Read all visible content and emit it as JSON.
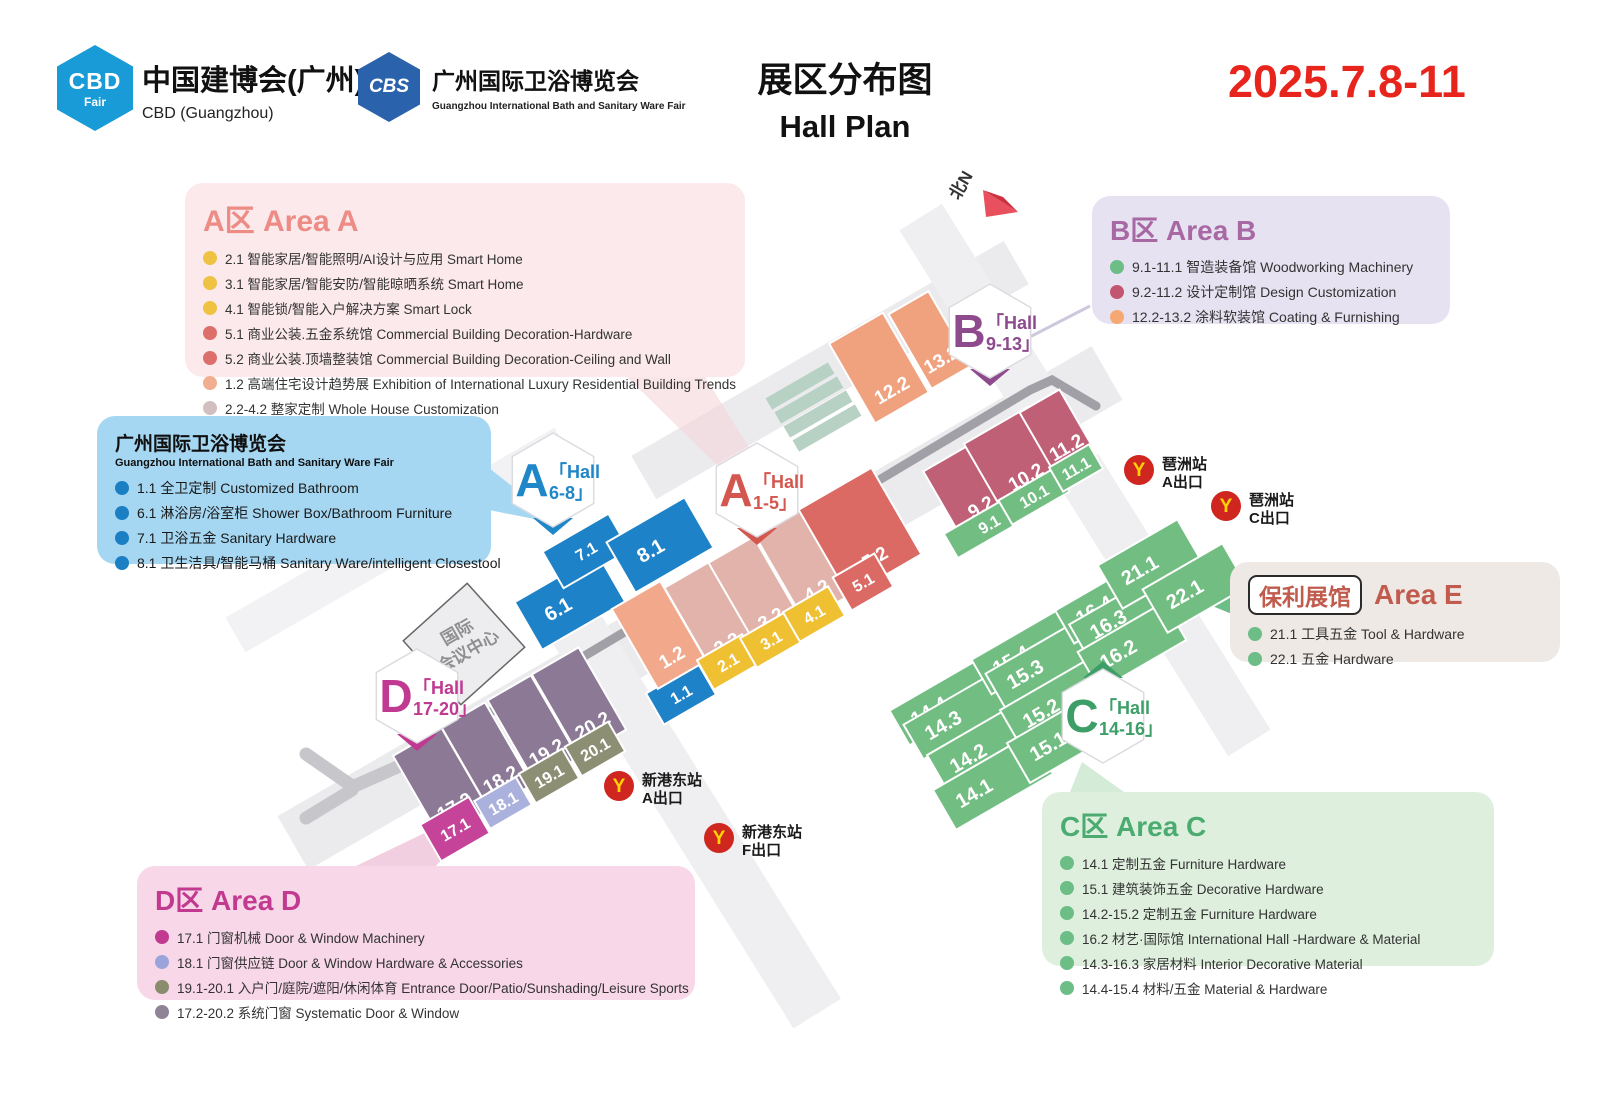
{
  "header": {
    "logo_cbd": {
      "badge_line1": "CBD",
      "badge_line2": "Fair",
      "title": "中国建博会(广州)",
      "subtitle": "CBD (Guangzhou)"
    },
    "logo_cbs": {
      "badge": "CBS",
      "title": "广州国际卫浴博览会",
      "subtitle": "Guangzhou International Bath and Sanitary Ware Fair"
    },
    "title_cn": "展区分布图",
    "title_en": "Hall Plan",
    "date": "2025.7.8-11"
  },
  "legends": {
    "a": {
      "title": "A区 Area A",
      "items": [
        {
          "dot": "#efc243",
          "text": "2.1 智能家居/智能照明/AI设计与应用 Smart Home"
        },
        {
          "dot": "#efc243",
          "text": "3.1 智能家居/智能安防/智能晾晒系统 Smart Home"
        },
        {
          "dot": "#efc243",
          "text": "4.1 智能锁/智能入户解决方案 Smart Lock"
        },
        {
          "dot": "#dd6f6b",
          "text": "5.1 商业公装.五金系统馆 Commercial Building Decoration-Hardware"
        },
        {
          "dot": "#dd6f6b",
          "text": "5.2 商业公装.顶墙整装馆 Commercial Building Decoration-Ceiling and Wall"
        },
        {
          "dot": "#f2ae90",
          "text": "1.2 高端住宅设计趋势展 Exhibition of International Luxury Residential Building Trends"
        },
        {
          "dot": "#d2bfc0",
          "text": "2.2-4.2 整家定制 Whole House Customization"
        }
      ]
    },
    "bath": {
      "title": "广州国际卫浴博览会",
      "subtitle": "Guangzhou International Bath and Sanitary Ware Fair",
      "items": [
        {
          "dot": "#1b7fc4",
          "text": "1.1 全卫定制 Customized Bathroom"
        },
        {
          "dot": "#1b7fc4",
          "text": "6.1 淋浴房/浴室柜 Shower Box/Bathroom Furniture"
        },
        {
          "dot": "#1b7fc4",
          "text": "7.1 卫浴五金 Sanitary Hardware"
        },
        {
          "dot": "#1b7fc4",
          "text": "8.1 卫生洁具/智能马桶 Sanitary Ware/intelligent Closestool"
        }
      ]
    },
    "b": {
      "title": "B区 Area B",
      "items": [
        {
          "dot": "#6cbd86",
          "text": "9.1-11.1 智造装备馆 Woodworking Machinery"
        },
        {
          "dot": "#c25670",
          "text": "9.2-11.2 设计定制馆 Design Customization"
        },
        {
          "dot": "#f6a873",
          "text": "12.2-13.2 涂料软装馆 Coating & Furnishing"
        }
      ]
    },
    "e": {
      "hall_badge": "保利展馆",
      "title": "Area E",
      "items": [
        {
          "dot": "#6cbd86",
          "text": "21.1 工具五金 Tool & Hardware"
        },
        {
          "dot": "#6cbd86",
          "text": "22.1 五金 Hardware"
        }
      ]
    },
    "c": {
      "title": "C区 Area C",
      "items": [
        {
          "dot": "#6cbd86",
          "text": "14.1 定制五金 Furniture Hardware"
        },
        {
          "dot": "#6cbd86",
          "text": "15.1 建筑装饰五金 Decorative Hardware"
        },
        {
          "dot": "#6cbd86",
          "text": "14.2-15.2 定制五金 Furniture Hardware"
        },
        {
          "dot": "#6cbd86",
          "text": "16.2 材艺·国际馆 International Hall -Hardware & Material"
        },
        {
          "dot": "#6cbd86",
          "text": "14.3-16.3 家居材料 Interior Decorative Material"
        },
        {
          "dot": "#6cbd86",
          "text": "14.4-15.4 材料/五金 Material & Hardware"
        }
      ]
    },
    "d": {
      "title": "D区 Area D",
      "items": [
        {
          "dot": "#c13a90",
          "text": "17.1 门窗机械  Door & Window Machinery"
        },
        {
          "dot": "#9ba4da",
          "text": "18.1 门窗供应链  Door & Window Hardware & Accessories"
        },
        {
          "dot": "#8a8c6e",
          "text": "19.1-20.1 入户门/庭院/遮阳/休闲体育 Entrance Door/Patio/Sunshading/Leisure Sports"
        },
        {
          "dot": "#8f8398",
          "text": "17.2-20.2 系统门窗 Systematic Door & Window"
        }
      ]
    }
  },
  "colors": {
    "halls": {
      "blue": "#1e82c8",
      "yellow": "#f0c033",
      "dustypink": "#e2b3ab",
      "salmon": "#f2a98b",
      "red": "#dc6a64",
      "orange": "#f0a17e",
      "darkpink": "#bf6077",
      "green": "#72bd82",
      "purple": "#8b7995",
      "magenta": "#c5449a",
      "periwinkle": "#abb1dd",
      "olive": "#8d8f75",
      "sage": "#b7d2c4"
    },
    "date_red": "#e8251d",
    "metro_red": "#cf2620",
    "metro_yellow": "#ffd400"
  },
  "map": {
    "north_label": "北N",
    "landmark": {
      "line1": "国际",
      "line2": "会议中心"
    },
    "roads": [
      {
        "x": 700,
        "y": 608,
        "w": 940,
        "h": 62,
        "rot": -30,
        "fill": "#ebebee"
      },
      {
        "x": 830,
        "y": 370,
        "w": 430,
        "h": 50,
        "rot": -30,
        "fill": "#ebebee"
      },
      {
        "x": 1085,
        "y": 480,
        "w": 620,
        "h": 50,
        "rot": 58,
        "fill": "#efeff1"
      },
      {
        "x": 690,
        "y": 810,
        "w": 480,
        "h": 56,
        "rot": 58,
        "fill": "#efeff1"
      },
      {
        "x": 400,
        "y": 540,
        "w": 380,
        "h": 40,
        "rot": -30,
        "fill": "#f2f2f4"
      },
      {
        "d": "M 390,772 L 1030,390 L 1052,380 L 1096,406",
        "stroke": "#a0a0a6",
        "sw": 9,
        "name": "road-main"
      },
      {
        "d": "M 306,754 L 352,786",
        "stroke": "#c6c6cb",
        "sw": 13,
        "name": "road-fork"
      },
      {
        "d": "M 306,818 L 352,790",
        "stroke": "#c6c6cb",
        "sw": 13,
        "name": "road-fork"
      },
      {
        "d": "M 350,788 L 404,764",
        "stroke": "#c6c6cb",
        "sw": 13,
        "name": "road-fork"
      }
    ],
    "beams": [
      {
        "points": "622,372 702,372 768,478 740,488",
        "fill": "#f5d6db",
        "opacity": 0.6,
        "name": "pointer-area-a"
      },
      {
        "points": "489,468 560,524 489,510",
        "fill": "#a5d7f2",
        "opacity": 1,
        "name": "pointer-bath"
      },
      {
        "d": "M 1090,306 L 1016,344",
        "stroke": "#cfc8dd",
        "sw": 3,
        "name": "pointer-area-b"
      },
      {
        "points": "1232,580 1232,614 1190,597",
        "fill": "#6cbd86",
        "opacity": 1,
        "name": "pointer-area-e"
      },
      {
        "points": "1082,762 1124,792 1066,802",
        "fill": "#d4ebd8",
        "opacity": 1,
        "name": "pointer-area-c"
      },
      {
        "points": "497,798 356,866 436,866",
        "fill": "#f0c6dc",
        "opacity": 0.85,
        "name": "pointer-area-d"
      }
    ],
    "halls": [
      {
        "label": "6.1",
        "x": 570,
        "y": 602,
        "w": 96,
        "h": 55,
        "c": "blue"
      },
      {
        "label": "7.1",
        "x": 586,
        "y": 551,
        "w": 76,
        "h": 42,
        "c": "blue"
      },
      {
        "label": "8.1",
        "x": 660,
        "y": 545,
        "w": 90,
        "h": 58,
        "c": "blue"
      },
      {
        "label": "1.1",
        "x": 681,
        "y": 694,
        "w": 60,
        "h": 36,
        "c": "blue"
      },
      {
        "label": "1.2",
        "x": 659,
        "y": 635,
        "w": 56,
        "h": 92,
        "c": "salmon"
      },
      {
        "label": "2.2",
        "x": 712,
        "y": 618,
        "w": 52,
        "h": 100,
        "c": "dustypink"
      },
      {
        "label": "3.2",
        "x": 756,
        "y": 593,
        "w": 52,
        "h": 100,
        "c": "dustypink"
      },
      {
        "label": "4.2",
        "x": 802,
        "y": 565,
        "w": 52,
        "h": 100,
        "c": "dustypink"
      },
      {
        "label": "5.2",
        "x": 860,
        "y": 532,
        "w": 84,
        "h": 100,
        "c": "red"
      },
      {
        "label": "2.1",
        "x": 728,
        "y": 662,
        "w": 52,
        "h": 34,
        "c": "yellow"
      },
      {
        "label": "3.1",
        "x": 771,
        "y": 640,
        "w": 52,
        "h": 34,
        "c": "yellow"
      },
      {
        "label": "4.1",
        "x": 814,
        "y": 614,
        "w": 52,
        "h": 34,
        "c": "yellow"
      },
      {
        "label": "5.1",
        "x": 863,
        "y": 582,
        "w": 48,
        "h": 38,
        "c": "red"
      },
      {
        "label": "12.2",
        "x": 879,
        "y": 368,
        "w": 62,
        "h": 92,
        "c": "orange"
      },
      {
        "label": "13.2",
        "x": 930,
        "y": 340,
        "w": 46,
        "h": 86,
        "c": "orange"
      },
      {
        "label": "9.2",
        "x": 971,
        "y": 490,
        "w": 64,
        "h": 80,
        "c": "darkpink"
      },
      {
        "label": "10.2",
        "x": 1016,
        "y": 460,
        "w": 74,
        "h": 80,
        "c": "darkpink"
      },
      {
        "label": "11.2",
        "x": 1058,
        "y": 433,
        "w": 46,
        "h": 74,
        "c": "darkpink"
      },
      {
        "label": "9.1",
        "x": 989,
        "y": 524,
        "w": 88,
        "h": 28,
        "c": "green"
      },
      {
        "label": "10.1",
        "x": 1034,
        "y": 496,
        "w": 66,
        "h": 28,
        "c": "green"
      },
      {
        "label": "11.1",
        "x": 1076,
        "y": 468,
        "w": 46,
        "h": 28,
        "c": "green"
      },
      {
        "label": "",
        "x": 800,
        "y": 386,
        "w": 72,
        "h": 13,
        "c": "sage"
      },
      {
        "label": "",
        "x": 809,
        "y": 400,
        "w": 72,
        "h": 13,
        "c": "sage"
      },
      {
        "label": "",
        "x": 818,
        "y": 414,
        "w": 72,
        "h": 13,
        "c": "sage"
      },
      {
        "label": "",
        "x": 827,
        "y": 428,
        "w": 72,
        "h": 13,
        "c": "sage"
      },
      {
        "label": "17.2",
        "x": 441,
        "y": 783,
        "w": 56,
        "h": 95,
        "c": "purple"
      },
      {
        "label": "18.2",
        "x": 487,
        "y": 756,
        "w": 50,
        "h": 95,
        "c": "purple"
      },
      {
        "label": "19.2",
        "x": 533,
        "y": 729,
        "w": 50,
        "h": 95,
        "c": "purple"
      },
      {
        "label": "20.2",
        "x": 579,
        "y": 702,
        "w": 54,
        "h": 95,
        "c": "purple"
      },
      {
        "label": "17.1",
        "x": 455,
        "y": 829,
        "w": 56,
        "h": 42,
        "c": "magenta"
      },
      {
        "label": "18.1",
        "x": 503,
        "y": 803,
        "w": 48,
        "h": 32,
        "c": "periwinkle"
      },
      {
        "label": "19.1",
        "x": 549,
        "y": 776,
        "w": 50,
        "h": 34,
        "c": "olive"
      },
      {
        "label": "20.1",
        "x": 595,
        "y": 749,
        "w": 50,
        "h": 34,
        "c": "olive"
      },
      {
        "label": "14.4",
        "x": 948,
        "y": 700,
        "w": 112,
        "h": 40,
        "c": "green"
      },
      {
        "label": "14.3",
        "x": 962,
        "y": 714,
        "w": 112,
        "h": 40,
        "c": "green"
      },
      {
        "label": "14.2",
        "x": 987,
        "y": 747,
        "w": 112,
        "h": 46,
        "c": "green"
      },
      {
        "label": "14.1",
        "x": 993,
        "y": 782,
        "w": 112,
        "h": 46,
        "c": "green"
      },
      {
        "label": "15.4",
        "x": 1030,
        "y": 649,
        "w": 112,
        "h": 40,
        "c": "green"
      },
      {
        "label": "15.3",
        "x": 1044,
        "y": 663,
        "w": 112,
        "h": 40,
        "c": "green"
      },
      {
        "label": "15.2",
        "x": 1060,
        "y": 702,
        "w": 112,
        "h": 46,
        "c": "green"
      },
      {
        "label": "15.1",
        "x": 1067,
        "y": 735,
        "w": 112,
        "h": 46,
        "c": "green"
      },
      {
        "label": "16.4",
        "x": 1108,
        "y": 602,
        "w": 100,
        "h": 38,
        "c": "green"
      },
      {
        "label": "16.3",
        "x": 1122,
        "y": 616,
        "w": 100,
        "h": 38,
        "c": "green"
      },
      {
        "label": "16.2",
        "x": 1132,
        "y": 646,
        "w": 100,
        "h": 44,
        "c": "green"
      },
      {
        "label": "21.1",
        "x": 1150,
        "y": 564,
        "w": 92,
        "h": 50,
        "c": "green"
      },
      {
        "label": "22.1",
        "x": 1195,
        "y": 588,
        "w": 92,
        "h": 50,
        "c": "green"
      }
    ],
    "badges": [
      {
        "letter": "A",
        "l1": "「Hall",
        "l2": "6-8」",
        "x": 553,
        "y": 480,
        "color": "#1f86c8",
        "tri": "below"
      },
      {
        "letter": "A",
        "l1": "「Hall",
        "l2": "1-5」",
        "x": 757,
        "y": 490,
        "color": "#d4574f",
        "tri": "below"
      },
      {
        "letter": "B",
        "l1": "「Hall",
        "l2": "9-13」",
        "x": 990,
        "y": 331,
        "color": "#8d4a8d",
        "tri": "below"
      },
      {
        "letter": "C",
        "l1": "「Hall",
        "l2": "14-16」",
        "x": 1103,
        "y": 716,
        "color": "#3d9e68",
        "tri": "above"
      },
      {
        "letter": "D",
        "l1": "「Hall",
        "l2": "17-20」",
        "x": 417,
        "y": 696,
        "color": "#bf3a90",
        "tri": "below"
      }
    ],
    "stations": [
      {
        "name": "琶洲站",
        "exit": "A出口",
        "x": 1139,
        "y": 470
      },
      {
        "name": "琶洲站",
        "exit": "C出口",
        "x": 1226,
        "y": 506
      },
      {
        "name": "新港东站",
        "exit": "A出口",
        "x": 619,
        "y": 786
      },
      {
        "name": "新港东站",
        "exit": "F出口",
        "x": 719,
        "y": 838
      }
    ]
  }
}
